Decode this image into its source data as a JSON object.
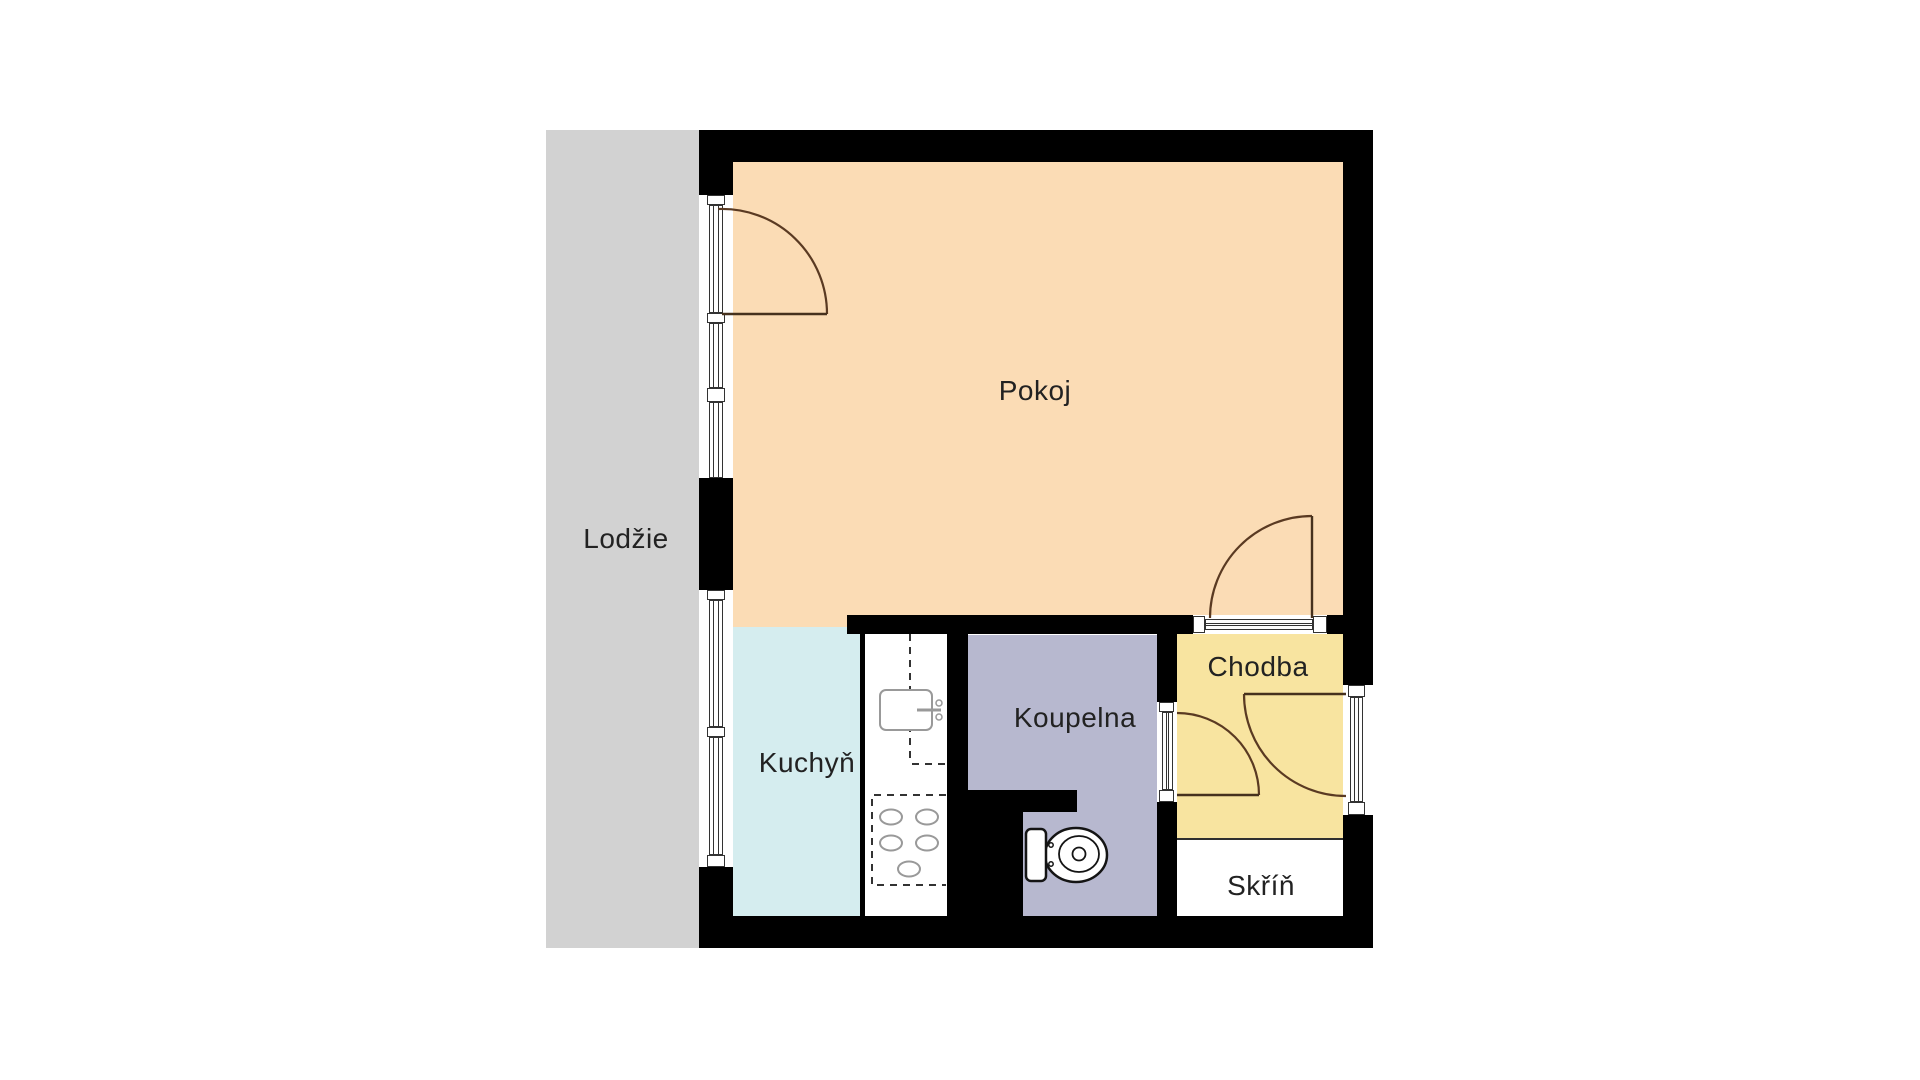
{
  "plan": {
    "type": "apartment-floor-plan",
    "rooms": {
      "pokoj": {
        "label": "Pokoj",
        "color": "#FBDCB5"
      },
      "lodzie": {
        "label": "Lodžie",
        "color": "#D2D2D2"
      },
      "kuchyn": {
        "label": "Kuchyň",
        "color": "#D5EDEF"
      },
      "koupelna": {
        "label": "Koupelna",
        "color": "#B7B8CF"
      },
      "chodba": {
        "label": "Chodba",
        "color": "#F8E4A0"
      },
      "skrin": {
        "label": "Skříň",
        "color": "#FFFFFF"
      }
    },
    "colors": {
      "background": "#FFFFFF",
      "walls": "#000000",
      "door_arc": "#5A3A22",
      "door_leaf": "#46311D",
      "window_frame": "#333333",
      "fixture_gray": "#999999",
      "toilet_outline": "#141414",
      "label_text": "#222222"
    },
    "fixtures": [
      {
        "name": "kitchen-sink",
        "location": "kuchyn-counter"
      },
      {
        "name": "stove-burners",
        "location": "kuchyn-counter",
        "burner_count": 5
      },
      {
        "name": "toilet",
        "location": "koupelna"
      }
    ],
    "doors": [
      {
        "name": "balcony-door",
        "between": [
          "lodzie",
          "pokoj"
        ]
      },
      {
        "name": "room-door",
        "between": [
          "pokoj",
          "chodba"
        ]
      },
      {
        "name": "bathroom-door",
        "between": [
          "chodba",
          "koupelna"
        ]
      },
      {
        "name": "entry-door",
        "between": [
          "exterior",
          "chodba"
        ]
      }
    ]
  }
}
